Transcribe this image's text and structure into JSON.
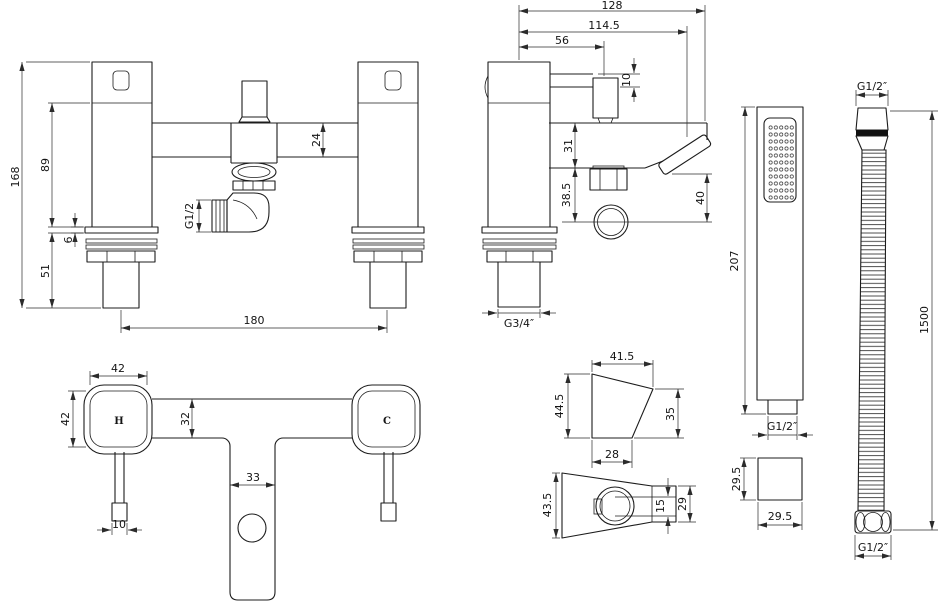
{
  "style": {
    "background": "#ffffff",
    "line_color": "#1c1c1c",
    "dim_color": "#2b2b2b"
  },
  "views": {
    "front": {
      "dims": {
        "overall_height": "168",
        "body_height": "89",
        "deck_plate": "6",
        "shank_length": "51",
        "spout_height": "24",
        "outlet_thread": "G1/2",
        "hole_centres": "180"
      }
    },
    "side": {
      "dims": {
        "depth_overall": "128",
        "depth_to_handle": "114.5",
        "depth_to_lever": "56",
        "lever_thickness": "10",
        "spout_drop": "31",
        "outlet_drop": "38.5",
        "valve_height": "40",
        "inlet_thread": "G3/4″"
      }
    },
    "plan": {
      "hot": "H",
      "cold": "C",
      "dims": {
        "handle_width": "42",
        "handle_depth": "42",
        "body_width": "32",
        "spout_width": "33",
        "lever_width": "10"
      }
    },
    "handset": {
      "dims": {
        "length": "207",
        "outlet_thread": "G1/2″",
        "section_height": "29.5",
        "section_width": "29.5"
      }
    },
    "hose": {
      "dims": {
        "top_thread": "G1/2″",
        "length": "1500",
        "bottom_thread": "G1/2″"
      }
    },
    "bracket_side": {
      "dims": {
        "top_width": "41.5",
        "front_height": "44.5",
        "back_height": "35",
        "base_width": "28"
      }
    },
    "bracket_bottom": {
      "dims": {
        "length": "43.5",
        "slot_width": "15",
        "clip_width": "29"
      }
    }
  }
}
